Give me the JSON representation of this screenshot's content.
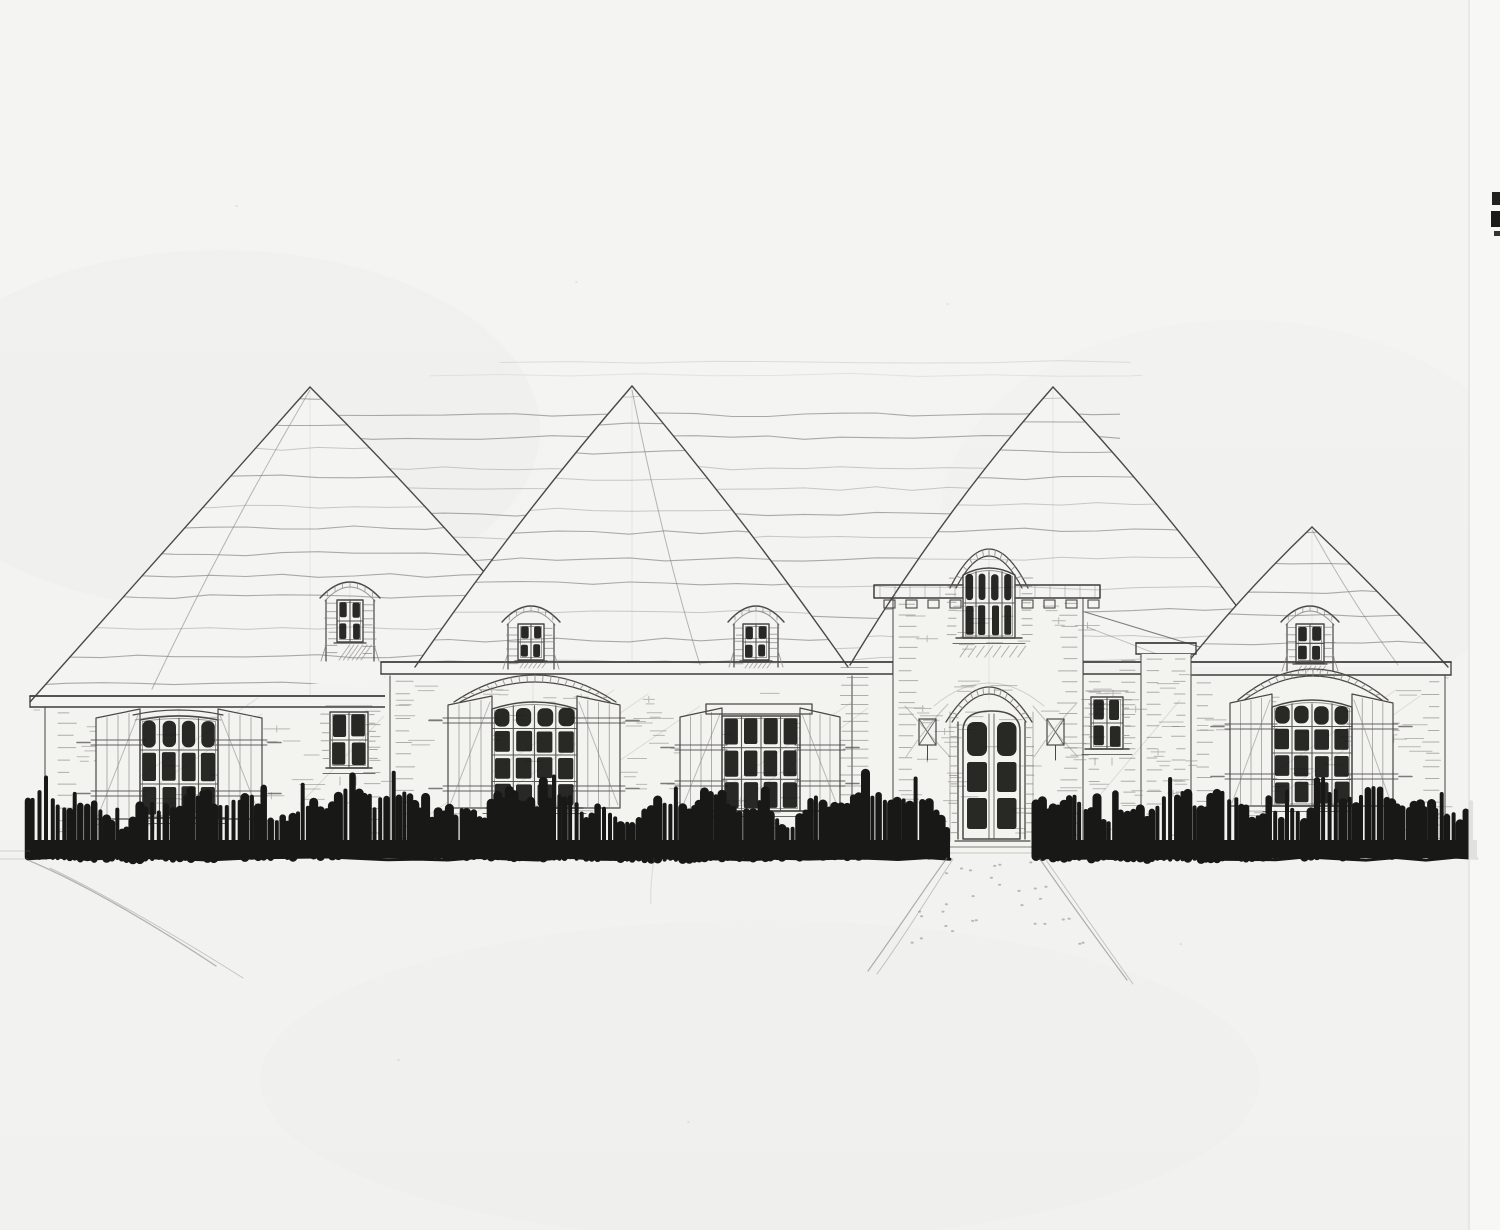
{
  "sheet": {
    "kind": "Hand-drawn architectural front elevation sketch",
    "subject": "French country style single-family residence",
    "medium": "graphite pencil and black marker on white drawing paper"
  },
  "colors": {
    "paper": "#f3f3f1",
    "paper_shade": "#ededea",
    "edge_strip": "#f7f7f5",
    "edge_line": "#dbdad7",
    "outline": "#4a4845",
    "fascia": "#3f3d3a",
    "pencil": "#807e79",
    "pencil_light": "#a8a6a1",
    "ink": "#181816"
  },
  "inventory": {
    "hip_roofs": [
      "left hip roof",
      "center-left hip roof",
      "main central hip roof",
      "right hip roof"
    ],
    "dormers": 4,
    "entry_tower": "central tower with corbelled cornice and arched upper window",
    "front_door": "arched double entry door with six dark lites and brick arch surround",
    "shuttered_windows": 4,
    "small_windows": 2,
    "porch_lanterns": 2,
    "landscape": [
      "continuous dark hedge row across foundation",
      "flared front walkway",
      "curved driveway line at left"
    ]
  }
}
